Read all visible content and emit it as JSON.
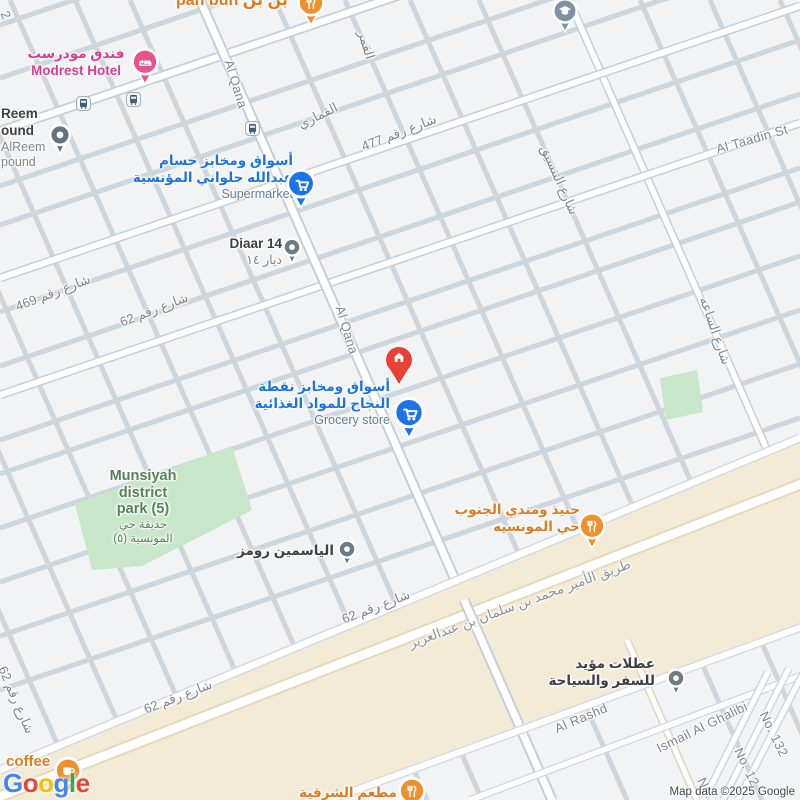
{
  "attribution": "Map data ©2025 Google",
  "colors": {
    "land": "#F1F3F4",
    "road_minor": "#CDD5DD",
    "road_fill": "#FFFFFF",
    "road_casing": "#C6CFD8",
    "highway_zone": "#F3EBD5",
    "highway_casing": "#E3D9BC",
    "park_green": "#C8E6C9",
    "street_text": "#7F858D",
    "highway_text": "#8D9199",
    "poi_blue": "#1A73E8",
    "poi_blue_secondary": "#5F7E99",
    "poi_pink": "#E03A8C",
    "poi_orange": "#E07A1F",
    "poi_green": "#567F5B",
    "poi_dark": "#3C4043",
    "pin_red": "#E94235",
    "pin_blue": "#1A73E8",
    "pin_orange": "#F0902D",
    "pin_pink": "#E7538D",
    "pin_gray": "#6E7B87",
    "pin_school": "#7D93A2"
  },
  "google_logo": [
    {
      "ch": "G",
      "c": "#4285F4"
    },
    {
      "ch": "o",
      "c": "#EA4335"
    },
    {
      "ch": "o",
      "c": "#FBBC05"
    },
    {
      "ch": "g",
      "c": "#4285F4"
    },
    {
      "ch": "l",
      "c": "#34A853"
    },
    {
      "ch": "e",
      "c": "#EA4335"
    }
  ],
  "streets": [
    {
      "id": "al-qamar",
      "t": "القمر",
      "x": 366,
      "y": 45,
      "r": 73
    },
    {
      "id": "al-qamari",
      "t": "القماري",
      "x": 318,
      "y": 116,
      "r": -26
    },
    {
      "id": "street-477",
      "t": "شارع رقم 477",
      "x": 399,
      "y": 133,
      "r": -21
    },
    {
      "id": "al-qana-north",
      "t": "Al Qana",
      "x": 236,
      "y": 84,
      "r": 73
    },
    {
      "id": "al-tansiq",
      "t": "شارع التنسيق",
      "x": 559,
      "y": 180,
      "r": 66
    },
    {
      "id": "al-taadin",
      "t": "Al Taadin St",
      "x": 752,
      "y": 139,
      "r": -16
    },
    {
      "id": "street-469",
      "t": "شارع رقم 469",
      "x": 53,
      "y": 293,
      "r": -21
    },
    {
      "id": "street-62-a",
      "t": "شارع رقم 62",
      "x": 154,
      "y": 310,
      "r": -21
    },
    {
      "id": "al-qana-south",
      "t": "Al Qana",
      "x": 347,
      "y": 330,
      "r": 73
    },
    {
      "id": "al-saah",
      "t": "شارع الساعه",
      "x": 715,
      "y": 331,
      "r": 71
    },
    {
      "id": "street-62-b",
      "t": "شارع رقم 62",
      "x": 16,
      "y": 700,
      "r": 67
    },
    {
      "id": "street-62-c",
      "t": "شارع رقم 62",
      "x": 178,
      "y": 697,
      "r": -21
    },
    {
      "id": "street-62-d",
      "t": "شارع رقم 62",
      "x": 376,
      "y": 607,
      "r": -21
    },
    {
      "id": "prince-mohammed-bin-salman-road",
      "t": "طريق الأمير محمد بن سلمان بن عبدالعزيز",
      "x": 520,
      "y": 604,
      "r": -20,
      "k": "hwy"
    },
    {
      "id": "al-rashd",
      "t": "Al Rashd",
      "x": 581,
      "y": 718,
      "r": -23
    },
    {
      "id": "ismail-al-ghalibi",
      "t": "Ismail Al Ghalibi",
      "x": 702,
      "y": 727,
      "r": -26
    },
    {
      "id": "no-132",
      "t": "No. 132",
      "x": 774,
      "y": 734,
      "r": 64
    },
    {
      "id": "no-12",
      "t": "No. 12",
      "x": 747,
      "y": 767,
      "r": 64
    },
    {
      "id": "no-partial",
      "t": "No.",
      "x": 706,
      "y": 788,
      "r": 64
    },
    {
      "id": "street-partial-2",
      "t": "2",
      "x": 6,
      "y": 15,
      "r": 65
    }
  ],
  "pois": [
    {
      "id": "pan-bun",
      "tone": "orange",
      "size": "xl",
      "anchor": "l",
      "x": 176,
      "y": -9,
      "lines": [
        "pan bun بن بن"
      ],
      "sec": [],
      "pin": {
        "type": "fork",
        "x": 311,
        "y": 3,
        "s": 30,
        "c": "#F0902D"
      }
    },
    {
      "id": "modrest-hotel",
      "tone": "pink",
      "anchor": "c",
      "x": 76,
      "y": 46,
      "lines": [
        "فندق مودرست",
        "Modrest Hotel"
      ],
      "sec": [],
      "pin": {
        "type": "bed",
        "x": 145,
        "y": 62,
        "s": 30,
        "c": "#E7538D"
      }
    },
    {
      "id": "alreem-compound",
      "tone": "dark",
      "anchor": "l",
      "x": 1,
      "y": 106,
      "lines": [
        "Reem",
        "ound"
      ],
      "sec": [
        "AlReem",
        "pound"
      ],
      "pin": {
        "type": "dot",
        "x": 60,
        "y": 135,
        "s": 26,
        "c": "#66737E"
      }
    },
    {
      "id": "school",
      "tone": "dark",
      "anchor": "l",
      "x": 0,
      "y": 0,
      "lines": [],
      "sec": [],
      "pin": {
        "type": "grad",
        "x": 565,
        "y": 11,
        "s": 28,
        "c": "#7D93A2"
      }
    },
    {
      "id": "hussam-supermarket",
      "tone": "blue",
      "anchor": "r",
      "x": 293,
      "y": 153,
      "lines": [
        "أسواق ومخابز حسام",
        "عبدالله حلواني المؤنسية"
      ],
      "sec": [
        "Supermarket"
      ],
      "pin": {
        "type": "cart",
        "x": 301,
        "y": 184,
        "s": 32,
        "c": "#1A73E8"
      }
    },
    {
      "id": "diaar-14",
      "tone": "dark",
      "anchor": "r",
      "x": 282,
      "y": 236,
      "lines": [
        "Diaar 14"
      ],
      "sec": [
        "ديار ١٤"
      ],
      "pin": {
        "type": "dot",
        "x": 292,
        "y": 247,
        "s": 22,
        "c": "#6E7B87"
      }
    },
    {
      "id": "najah-grocery",
      "tone": "blue",
      "anchor": "r",
      "x": 390,
      "y": 379,
      "lines": [
        "أسواق ومخابز نقطة",
        "النجاح للمواد الغذائية"
      ],
      "sec": [
        "Grocery store"
      ],
      "pin": {
        "type": "cart",
        "x": 409,
        "y": 413,
        "s": 34,
        "c": "#1A73E8"
      }
    },
    {
      "id": "home-property",
      "tone": "dark",
      "anchor": "l",
      "x": 0,
      "y": 0,
      "lines": [],
      "sec": [],
      "pin": {
        "type": "balloon",
        "x": 399,
        "y": 356,
        "s": 32,
        "c": "#E94235"
      }
    },
    {
      "id": "munsiyah-district-park",
      "tone": "green",
      "anchor": "c",
      "x": 143,
      "y": 468,
      "lines": [
        "Munsiyah",
        "district",
        "park (5)"
      ],
      "sec": [
        "حديقة حي",
        "المونسية (٥)"
      ],
      "pin": null
    },
    {
      "id": "yasmin-rooms",
      "tone": "dark",
      "anchor": "r",
      "x": 334,
      "y": 543,
      "lines": [
        "الياسمين رومز"
      ],
      "sec": [],
      "pin": {
        "type": "dot",
        "x": 347,
        "y": 549,
        "s": 22,
        "c": "#6E7B87"
      }
    },
    {
      "id": "haneeth-mandi-south",
      "tone": "orange",
      "anchor": "r",
      "x": 580,
      "y": 502,
      "lines": [
        "حنيذ ومندي الجنوب",
        "حي المونسيه"
      ],
      "sec": [],
      "pin": {
        "type": "fork",
        "x": 592,
        "y": 526,
        "s": 30,
        "c": "#F0902D"
      }
    },
    {
      "id": "otalat-moayad-travel",
      "tone": "dark",
      "anchor": "r",
      "x": 655,
      "y": 656,
      "lines": [
        "عطلات مؤيد",
        "للسفر والسياحة"
      ],
      "sec": [],
      "pin": {
        "type": "dot",
        "x": 676,
        "y": 678,
        "s": 22,
        "c": "#6E7B87"
      }
    },
    {
      "id": "coffee-shop",
      "tone": "orange",
      "size": "lg",
      "anchor": "l",
      "x": 6,
      "y": 753,
      "lines": [
        "coffee"
      ],
      "sec": [],
      "pin": {
        "type": "cup",
        "x": 68,
        "y": 771,
        "s": 30,
        "c": "#F0902D"
      }
    },
    {
      "id": "eastern-restaurant",
      "tone": "orange",
      "anchor": "r",
      "x": 397,
      "y": 785,
      "lines": [
        "مطعم الشرقية"
      ],
      "sec": [],
      "pin": {
        "type": "fork",
        "x": 412,
        "y": 791,
        "s": 30,
        "c": "#F0902D"
      }
    }
  ],
  "transit_stops": [
    {
      "x": 83,
      "y": 103
    },
    {
      "x": 133,
      "y": 99
    },
    {
      "x": 252,
      "y": 128
    }
  ]
}
